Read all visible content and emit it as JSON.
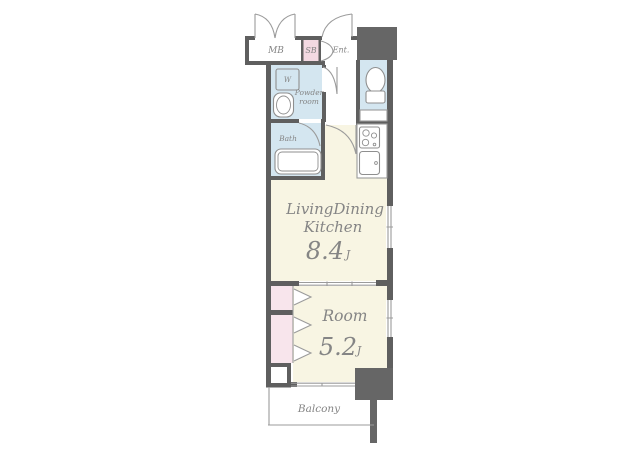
{
  "colors": {
    "wall": "#5f5f5f",
    "block": "#666666",
    "floor": "#f8f5e3",
    "wet": "#d4e6f0",
    "pink": "#f3d9e2",
    "pink-light": "#f8e5ec",
    "line": "#9b9b9b",
    "fixture": "#8f8f8f",
    "label": "#858585"
  },
  "labels": {
    "mb": "MB",
    "sb": "SB",
    "entrance": "Ent.",
    "washer": "W",
    "powder1": "Powder",
    "powder2": "room",
    "bath": "Bath",
    "ldk1": "LivingDining",
    "ldk2": "Kitchen",
    "ldk_size": "8.4",
    "ldk_unit": "J",
    "room": "Room",
    "room_size": "5.2",
    "room_unit": "J",
    "balcony": "Balcony"
  }
}
